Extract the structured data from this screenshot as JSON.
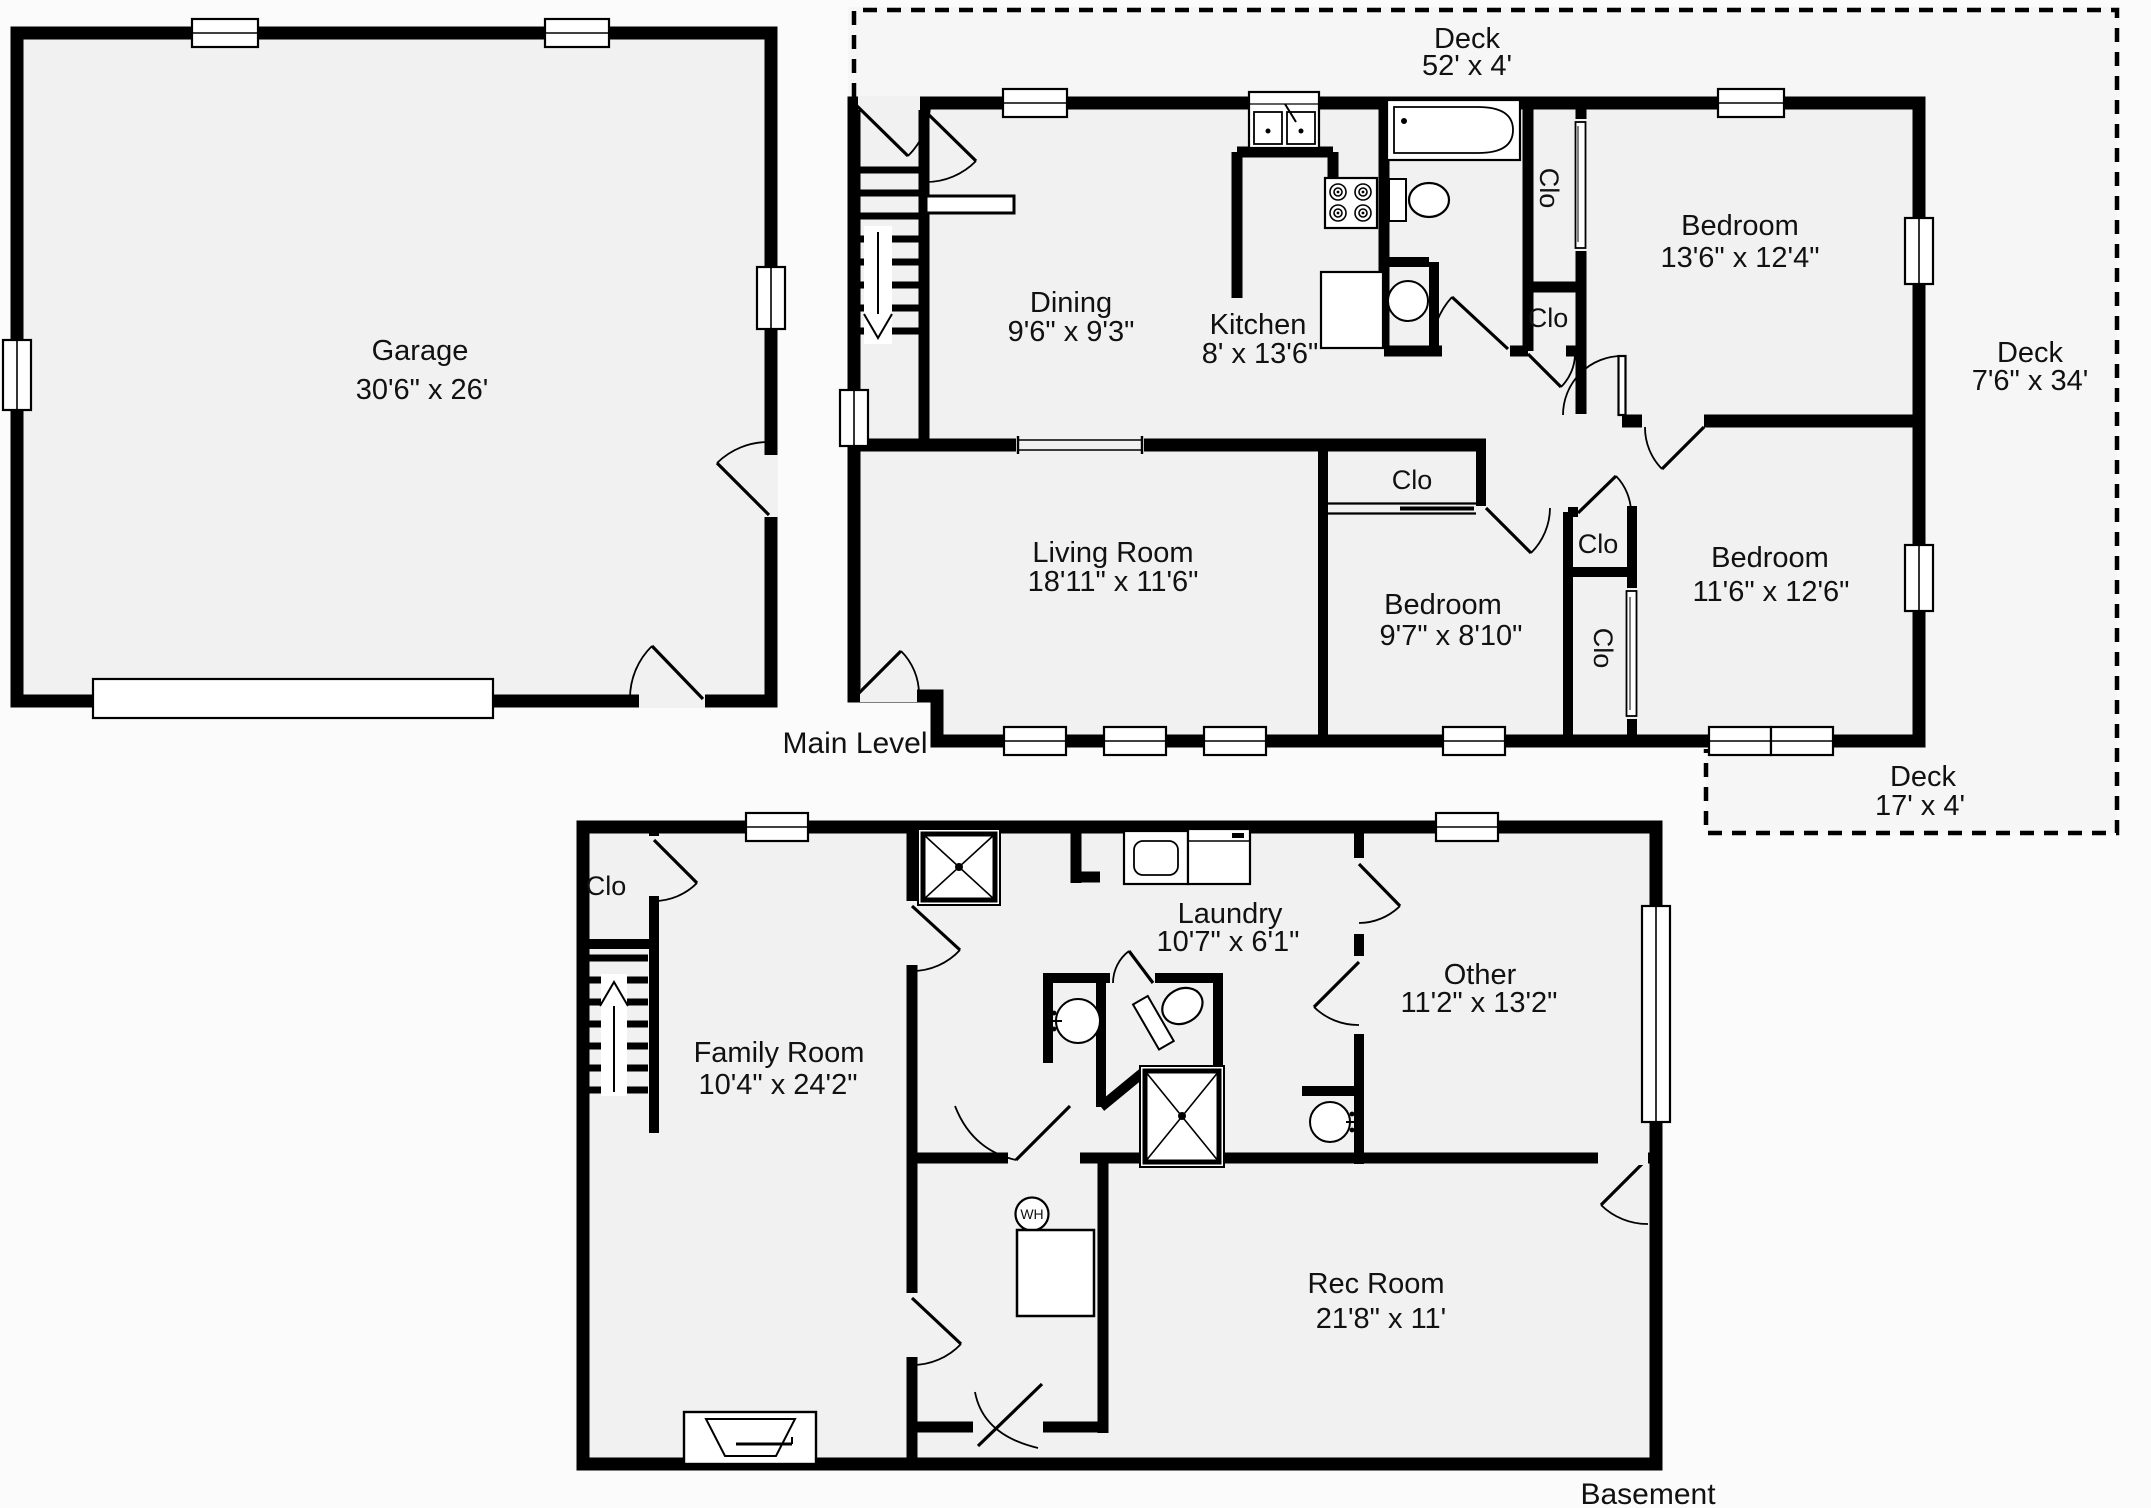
{
  "garage": {
    "label": "Garage",
    "dims": "30'6\" x 26'"
  },
  "main_level": {
    "label": "Main Level",
    "decks": {
      "top": {
        "label": "Deck",
        "dims": "52' x 4'"
      },
      "right": {
        "label": "Deck",
        "dims": "7'6\" x 34'"
      },
      "bottom": {
        "label": "Deck",
        "dims": "17' x 4'"
      }
    },
    "rooms": {
      "dining": {
        "label": "Dining",
        "dims": "9'6\" x 9'3\""
      },
      "kitchen": {
        "label": "Kitchen",
        "dims": "8' x 13'6\""
      },
      "bedroom1": {
        "label": "Bedroom",
        "dims": "13'6\" x 12'4\""
      },
      "living": {
        "label": "Living Room",
        "dims": "18'11\" x 11'6\""
      },
      "bedroom2": {
        "label": "Bedroom",
        "dims": "9'7\" x 8'10\""
      },
      "bedroom3": {
        "label": "Bedroom",
        "dims": "11'6\" x 12'6\""
      }
    },
    "closets": {
      "linen": "Clo",
      "hall": "Clo",
      "bedroom2": "Clo",
      "hall2": "Clo",
      "bedroom3": "Clo"
    }
  },
  "basement": {
    "label": "Basement",
    "rooms": {
      "family": {
        "label": "Family Room",
        "dims": "10'4\" x 24'2\""
      },
      "laundry": {
        "label": "Laundry",
        "dims": "10'7\" x 6'1\""
      },
      "other": {
        "label": "Other",
        "dims": "11'2\" x 13'2\""
      },
      "rec": {
        "label": "Rec Room",
        "dims": "21'8\" x 11'"
      }
    },
    "closet": "Clo",
    "water_heater": "WH"
  },
  "colors": {
    "wall": "#000000",
    "room_fill": "#f1f1f1",
    "background": "#fbfbfb",
    "text": "#111111"
  }
}
